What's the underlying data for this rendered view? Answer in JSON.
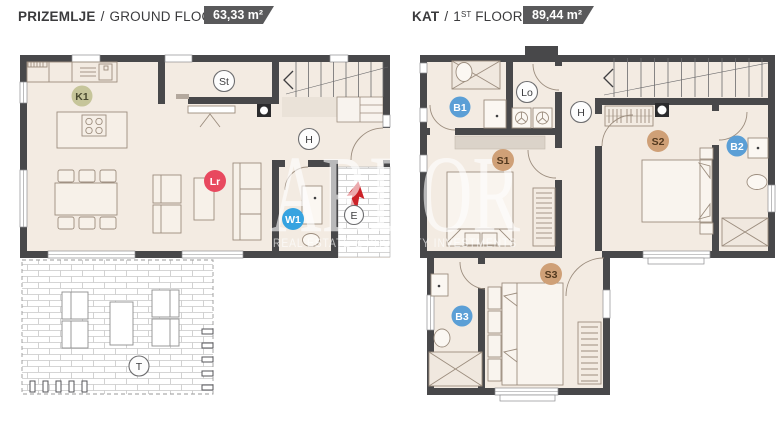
{
  "headers": {
    "ground": {
      "title": "PRIZEMLJE",
      "separator": "/",
      "subtitle": "GROUND FLOOR",
      "area": "63,33 m²"
    },
    "first": {
      "title": "KAT",
      "separator": "/",
      "floor_num": "1",
      "floor_ord": "ST",
      "subtitle": "FLOOR",
      "area": "89,44 m²"
    }
  },
  "watermark": {
    "title": "ARDOR",
    "subtitle": "REAL ESTATE & PROPERTY INVESTMENTS"
  },
  "ground_floor": {
    "labels": [
      {
        "id": "K1",
        "text": "K1",
        "fill": "#c6c59a",
        "stroke": "none",
        "text_color": "#49492f"
      },
      {
        "id": "St",
        "text": "St",
        "fill": "#fdfdfd",
        "stroke": "#6e6e70",
        "text_color": "#3d3d3f"
      },
      {
        "id": "H",
        "text": "H",
        "fill": "#fdfdfd",
        "stroke": "#6e6e70",
        "text_color": "#3d3d3f"
      },
      {
        "id": "Lr",
        "text": "Lr",
        "fill": "#e8495f",
        "stroke": "none",
        "text_color": "#ffffff"
      },
      {
        "id": "W1",
        "text": "W1",
        "fill": "#36a3e0",
        "stroke": "none",
        "text_color": "#ffffff"
      },
      {
        "id": "E",
        "text": "E",
        "fill": "#fdfdfd",
        "stroke": "#6e6e70",
        "text_color": "#3d3d3f"
      },
      {
        "id": "T",
        "text": "T",
        "fill": "#fdfdfd",
        "stroke": "#6e6e70",
        "text_color": "#3d3d3f"
      }
    ]
  },
  "first_floor": {
    "labels": [
      {
        "id": "B1",
        "text": "B1",
        "fill": "#5b9fd6",
        "stroke": "none",
        "text_color": "#ffffff"
      },
      {
        "id": "Lo",
        "text": "Lo",
        "fill": "#fdfdfd",
        "stroke": "#6e6e70",
        "text_color": "#3d3d3f"
      },
      {
        "id": "H",
        "text": "H",
        "fill": "#fdfdfd",
        "stroke": "#6e6e70",
        "text_color": "#3d3d3f"
      },
      {
        "id": "S1",
        "text": "S1",
        "fill": "#cfa077",
        "stroke": "none",
        "text_color": "#53391f"
      },
      {
        "id": "S2",
        "text": "S2",
        "fill": "#cfa077",
        "stroke": "none",
        "text_color": "#53391f"
      },
      {
        "id": "B2",
        "text": "B2",
        "fill": "#5b9fd6",
        "stroke": "none",
        "text_color": "#ffffff"
      },
      {
        "id": "S3",
        "text": "S3",
        "fill": "#cfa077",
        "stroke": "none",
        "text_color": "#53391f"
      },
      {
        "id": "B3",
        "text": "B3",
        "fill": "#5b9fd6",
        "stroke": "none",
        "text_color": "#ffffff"
      }
    ]
  },
  "colors": {
    "wall": "#48484a",
    "floor": "#f3ebe2",
    "badge_bg": "#59595b",
    "entry_arrow_red": "#cc2127",
    "furniture_line": "#9c8d7e",
    "brick_line": "#c8c8c8"
  }
}
